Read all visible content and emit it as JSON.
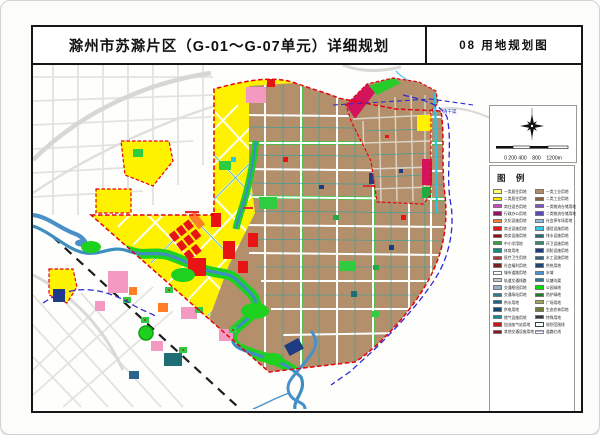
{
  "header": {
    "title_left": "滁州市苏滁片区（G-01～G-07单元）详细规划",
    "title_right": "08 用地规划图"
  },
  "compass_panel": {
    "scale_left": "0 200 400",
    "scale_mid": "800",
    "scale_right": "1200m"
  },
  "map_labels": {
    "canal": "清干渠"
  },
  "legend": {
    "title": "图 例",
    "left": [
      {
        "label": "一类居住用地",
        "color": "#FFFF73"
      },
      {
        "label": "二类居住用地",
        "color": "#FFE900"
      },
      {
        "label": "商住混合用地",
        "color": "#DC3CC8"
      },
      {
        "label": "行政办公用地",
        "color": "#A00A64"
      },
      {
        "label": "文化设施用地",
        "color": "#FF7D28"
      },
      {
        "label": "商业设施用地",
        "color": "#E81414"
      },
      {
        "label": "商务设施用地",
        "color": "#9B0A0A"
      },
      {
        "label": "中小学用地",
        "color": "#28A83C"
      },
      {
        "label": "体育用地",
        "color": "#128C82"
      },
      {
        "label": "医疗卫生用地",
        "color": "#B43028"
      },
      {
        "label": "社会福利用地",
        "color": "#7D1E1E"
      },
      {
        "label": "城市道路用地",
        "color": "#FFFFFF"
      },
      {
        "label": "轨道交通线路",
        "color": "#C9C9C9"
      },
      {
        "label": "交通枢纽用地",
        "color": "#97AECD"
      },
      {
        "label": "交通场站用地",
        "color": "#327D8C"
      },
      {
        "label": "供水用地",
        "color": "#14648C"
      },
      {
        "label": "供电用地",
        "color": "#0F4A73"
      },
      {
        "label": "燃气设施用地",
        "color": "#0E8C96"
      },
      {
        "label": "加油加气站用地",
        "color": "#CD1414"
      },
      {
        "label": "其他交通设施用地",
        "color": "#8C1414"
      }
    ],
    "right": [
      {
        "label": "一类工业用地",
        "color": "#B28B62"
      },
      {
        "label": "二类工业用地",
        "color": "#8B5F3C"
      },
      {
        "label": "一类物流仓储用地",
        "color": "#7D55C8"
      },
      {
        "label": "二类物流仓储用地",
        "color": "#5A46BE"
      },
      {
        "label": "社会停车场用地",
        "color": "#91BEE1"
      },
      {
        "label": "通信设施用地",
        "color": "#32C8E6"
      },
      {
        "label": "排水设施用地",
        "color": "#1E6E73"
      },
      {
        "label": "环卫设施用地",
        "color": "#2E8C73"
      },
      {
        "label": "消防设施用地",
        "color": "#1E3C82"
      },
      {
        "label": "水工设施用地",
        "color": "#2D648C"
      },
      {
        "label": "供热用地",
        "color": "#1E4678"
      },
      {
        "label": "水域",
        "color": "#4696DC"
      },
      {
        "label": "坑塘沟渠",
        "color": "#2E7896"
      },
      {
        "label": "公园绿地",
        "color": "#00DC00"
      },
      {
        "label": "防护绿地",
        "color": "#1E7D28"
      },
      {
        "label": "广场用地",
        "color": "#A5A55A"
      },
      {
        "label": "生态农林用地",
        "color": "#6E7D32"
      },
      {
        "label": "特殊用地",
        "color": "#2D3741"
      },
      {
        "label": "规划范围线",
        "type": "outline"
      },
      {
        "label": "道路红线",
        "type": "lines"
      }
    ]
  }
}
